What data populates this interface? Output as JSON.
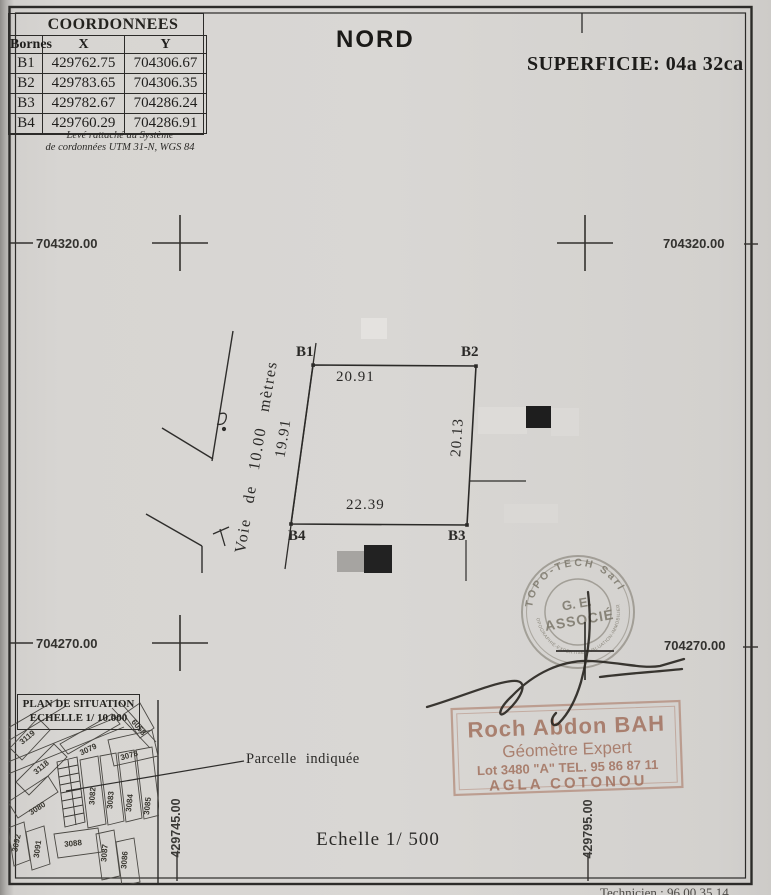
{
  "header": {
    "north": "NORD",
    "area": "SUPERFICIE: 04a 32ca"
  },
  "coord_table": {
    "title": "COORDONNEES",
    "col_borne": "Bornes",
    "col_x": "X",
    "col_y": "Y",
    "rows": [
      {
        "b": "B1",
        "x": "429762.75",
        "y": "704306.67"
      },
      {
        "b": "B2",
        "x": "429783.65",
        "y": "704306.35"
      },
      {
        "b": "B3",
        "x": "429782.67",
        "y": "704286.24"
      },
      {
        "b": "B4",
        "x": "429760.29",
        "y": "704286.91"
      }
    ],
    "note1": "Levé rattaché au Système",
    "note2": "de cordonnées UTM 31-N,  WGS 84"
  },
  "grid": {
    "y_north": "704320.00",
    "y_south": "704270.00",
    "x_west": "429745.00",
    "x_east": "429795.00"
  },
  "parcel": {
    "b1": "B1",
    "b2": "B2",
    "b3": "B3",
    "b4": "B4",
    "d_top": "20.91",
    "d_right": "20.13",
    "d_bottom": "22.39",
    "d_left": "19.91",
    "road": "Voie de 10.00 mètres"
  },
  "situation": {
    "title1": "PLAN DE SITUATION",
    "title2": "ECHELLE 1/ 10.000",
    "pointer": "Parcelle indiquée",
    "lots": [
      "3119",
      "3118",
      "3079",
      "6058",
      "3078",
      "3080",
      "3082",
      "3083",
      "3084",
      "3085",
      "3092",
      "3091",
      "3088",
      "3087",
      "3086"
    ]
  },
  "stamps": {
    "round_top": "TOPO-TECH Sarl",
    "round_center1": "G. E.",
    "round_center2": "ASSOCIÉ",
    "round_bottom": "TOPOGRAPHIE-EXPERTISE-EVALUATION-IMMOBILIERE",
    "rect_name": "Roch Abdon BAH",
    "rect_title": "Géomètre Expert",
    "rect_contact": "Lot  3480 \"A\"   TEL. 95 86 87 11",
    "rect_city": "AGLA   COTONOU"
  },
  "footer": {
    "scale": "Echelle 1/ 500",
    "bottom_partial": "Technicien : 96 00 35 14"
  },
  "colors": {
    "paper": "#d8d6d3",
    "ink": "#2c2b29",
    "stamp_round": "#625d4e",
    "stamp_rect": "#9e6a56"
  }
}
